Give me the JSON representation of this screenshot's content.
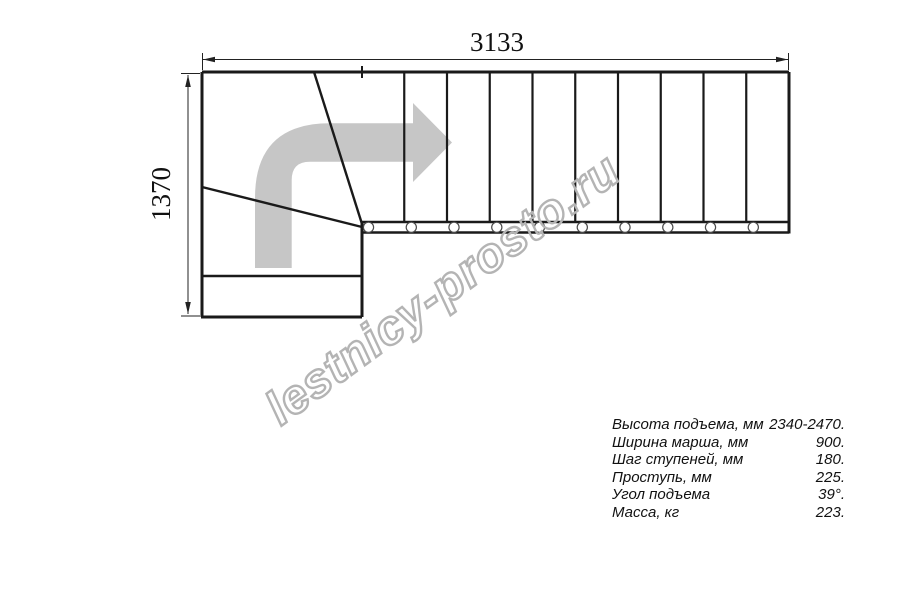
{
  "drawing": {
    "dimension_width_label": "3133",
    "dimension_height_label": "1370",
    "watermark_text": "lestnicy-prosto.ru",
    "colors": {
      "line": "#1a1a1a",
      "dimension": "#222222",
      "arrow_fill": "#c6c6c6",
      "watermark": "#b4b4b4",
      "circle_stroke": "#4a4a4a"
    },
    "stair": {
      "tread_count": 10,
      "mount_circle_count": 10
    }
  },
  "specs": {
    "rows": [
      {
        "label": "Высота подъема, мм",
        "value": "2340-2470."
      },
      {
        "label": "Ширина марша, мм",
        "value": "900."
      },
      {
        "label": "Шаг ступеней, мм",
        "value": "180."
      },
      {
        "label": "Проступь, мм",
        "value": "225."
      },
      {
        "label": "Угол подъема",
        "value": "39°."
      },
      {
        "label": "Масса, кг",
        "value": "223."
      }
    ]
  }
}
